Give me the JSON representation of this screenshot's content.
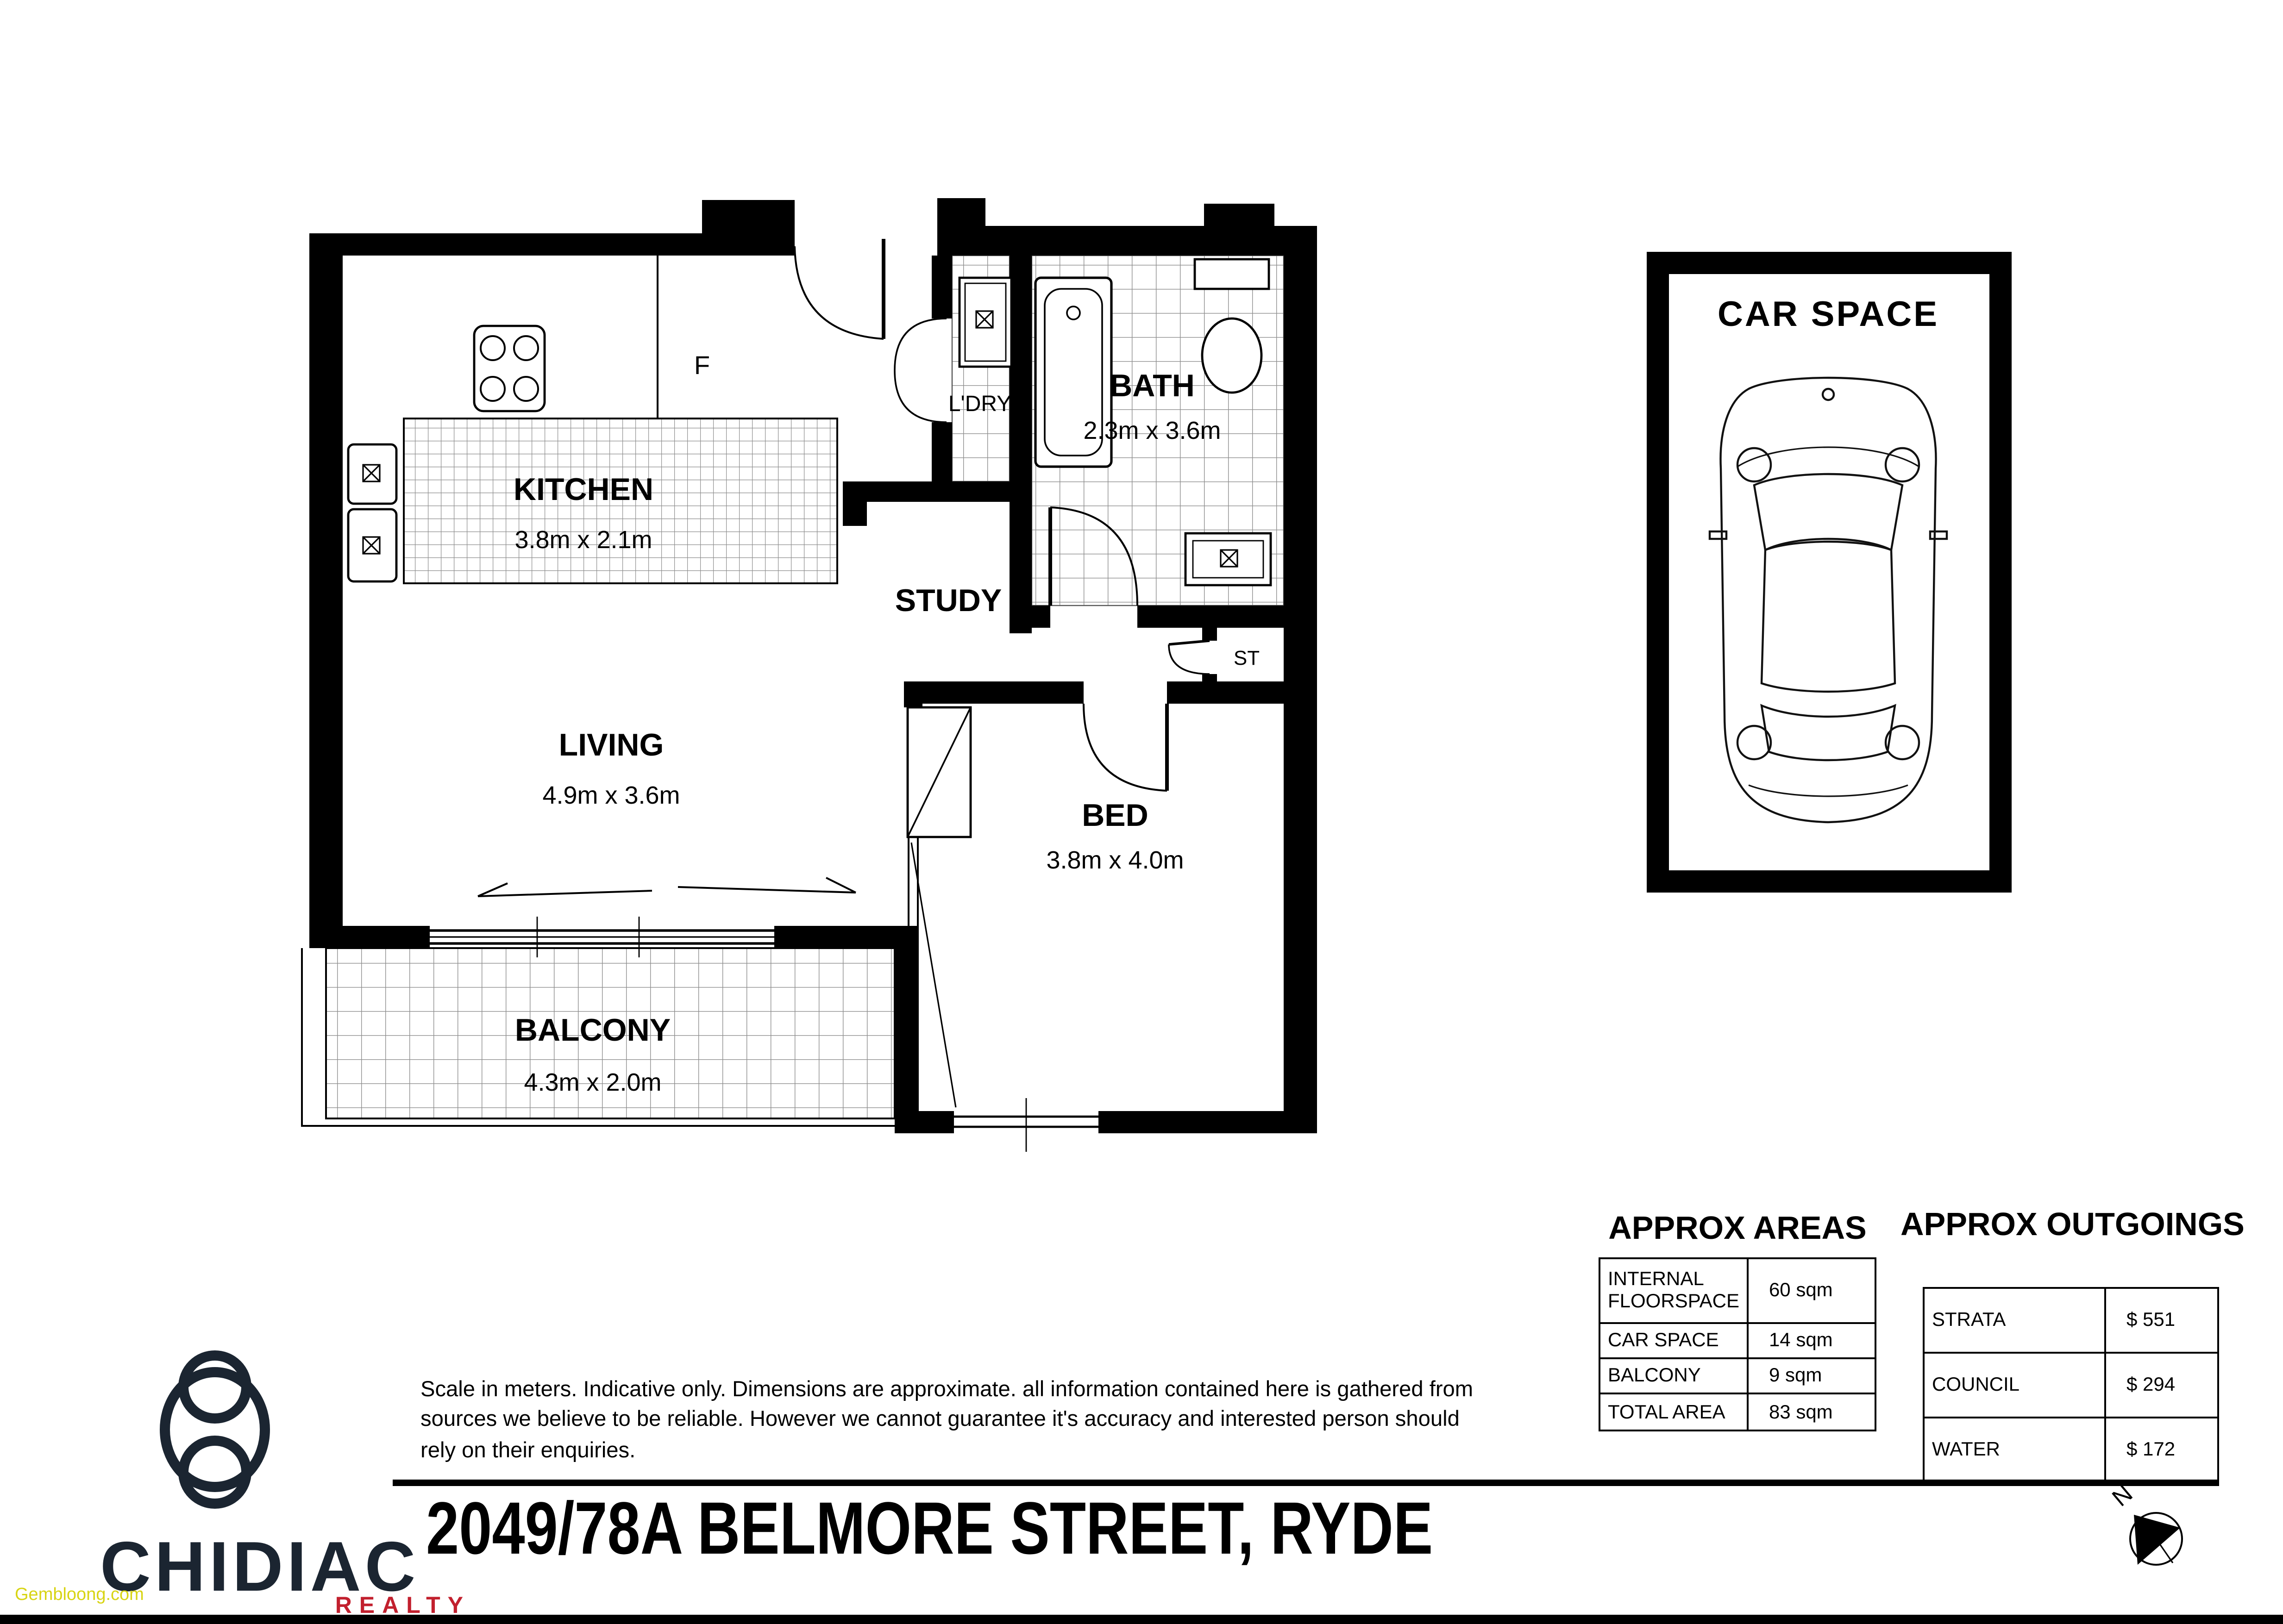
{
  "page": {
    "title": "2049/78A BELMORE STREET, RYDE"
  },
  "floorplan": {
    "rooms": [
      {
        "name": "KITCHEN",
        "dims": "3.8m x 2.1m"
      },
      {
        "name": "LIVING",
        "dims": "4.9m x 3.6m"
      },
      {
        "name": "BATH",
        "dims": "2.3m x 3.6m"
      },
      {
        "name": "BED",
        "dims": "3.8m x 4.0m"
      },
      {
        "name": "BALCONY",
        "dims": "4.3m x 2.0m"
      },
      {
        "name": "STUDY"
      },
      {
        "name": "L'DRY"
      },
      {
        "name": "ST"
      }
    ],
    "fridge_label": "F",
    "north_label": "N"
  },
  "car_space": {
    "label": "CAR SPACE"
  },
  "areas_table": {
    "title": "APPROX AREAS",
    "rows": [
      {
        "label": "INTERNAL FLOORSPACE",
        "value": "60 sqm"
      },
      {
        "label": "CAR SPACE",
        "value": "14 sqm"
      },
      {
        "label": "BALCONY",
        "value": "9 sqm"
      },
      {
        "label": "TOTAL AREA",
        "value": "83 sqm"
      }
    ]
  },
  "outgoings_table": {
    "title": "APPROX OUTGOINGS",
    "rows": [
      {
        "label": "STRATA",
        "value": "$ 551"
      },
      {
        "label": "COUNCIL",
        "value": "$ 294"
      },
      {
        "label": "WATER",
        "value": "$ 172"
      }
    ]
  },
  "disclaimer": {
    "line1": "Scale in meters. Indicative only. Dimensions are approximate. all information contained here is gathered from",
    "line2": "sources we believe to be reliable. However we cannot guarantee it's accuracy and interested person should",
    "line3": "rely on their enquiries."
  },
  "branding": {
    "name": "CHIDIAC",
    "sub": "REALTY",
    "watermark": "Gembloong.com"
  },
  "colors": {
    "brand_navy": "#1b2531",
    "brand_red": "#c2202e",
    "watermark_yellow": "#d8d414",
    "line_black": "#000000"
  }
}
